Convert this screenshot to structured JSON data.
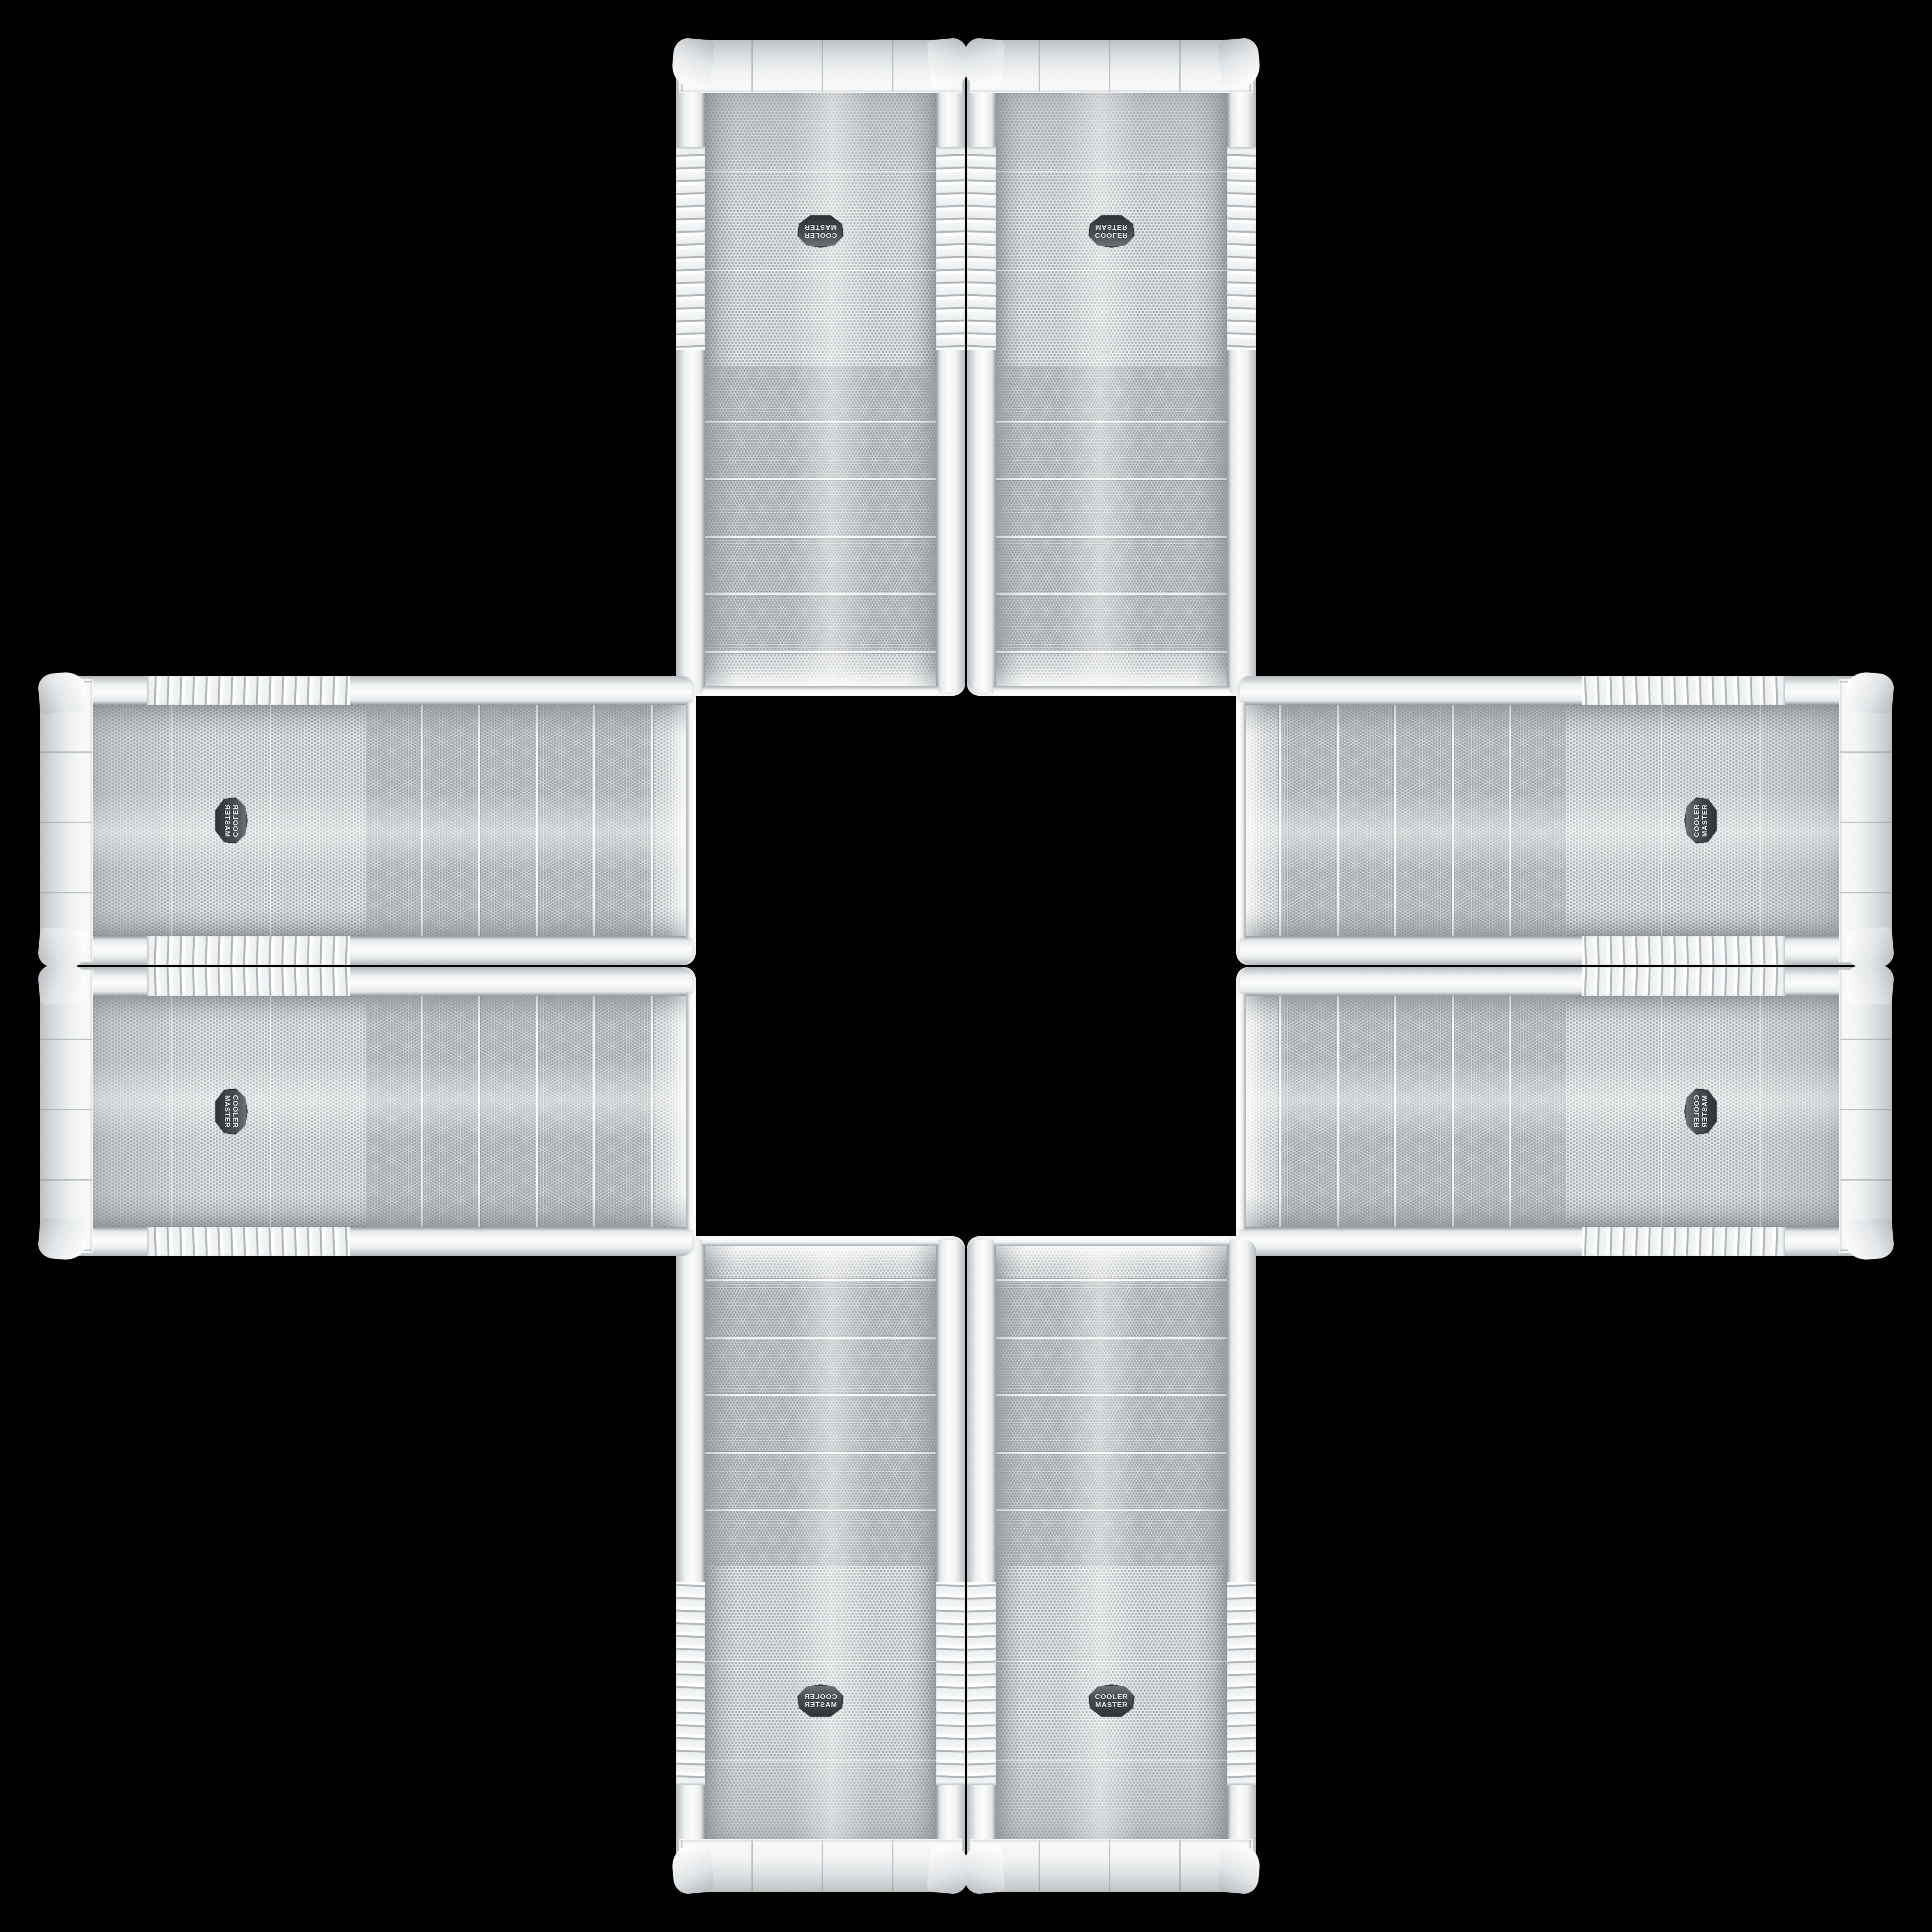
{
  "brand": {
    "line1": "COOLER",
    "line2": "MASTER"
  },
  "collage": {
    "unit_count": 8,
    "pattern": "plus-cross",
    "units": [
      {
        "id": "tower-top-left",
        "orientation": "rotated-180"
      },
      {
        "id": "tower-top-right",
        "orientation": "flipped-vertical"
      },
      {
        "id": "tower-bottom-left",
        "orientation": "flipped-horizontal"
      },
      {
        "id": "tower-bottom-right",
        "orientation": "upright"
      },
      {
        "id": "case-left-top",
        "orientation": "rotated-90-cw-flipped"
      },
      {
        "id": "case-left-bottom",
        "orientation": "rotated-90-cw"
      },
      {
        "id": "case-right-top",
        "orientation": "rotated-90-ccw"
      },
      {
        "id": "case-right-bottom",
        "orientation": "rotated-90-ccw-flipped"
      }
    ]
  },
  "colors": {
    "background": "#000000",
    "case_body": "#eef0f1",
    "case_shade": "#c2c6c9",
    "mesh_base": "#e8eaeb",
    "mesh_dot": "#aab0b3",
    "seam": "#848b8f",
    "badge_face": "#3c4144",
    "badge_text": "#f4f5f6"
  }
}
